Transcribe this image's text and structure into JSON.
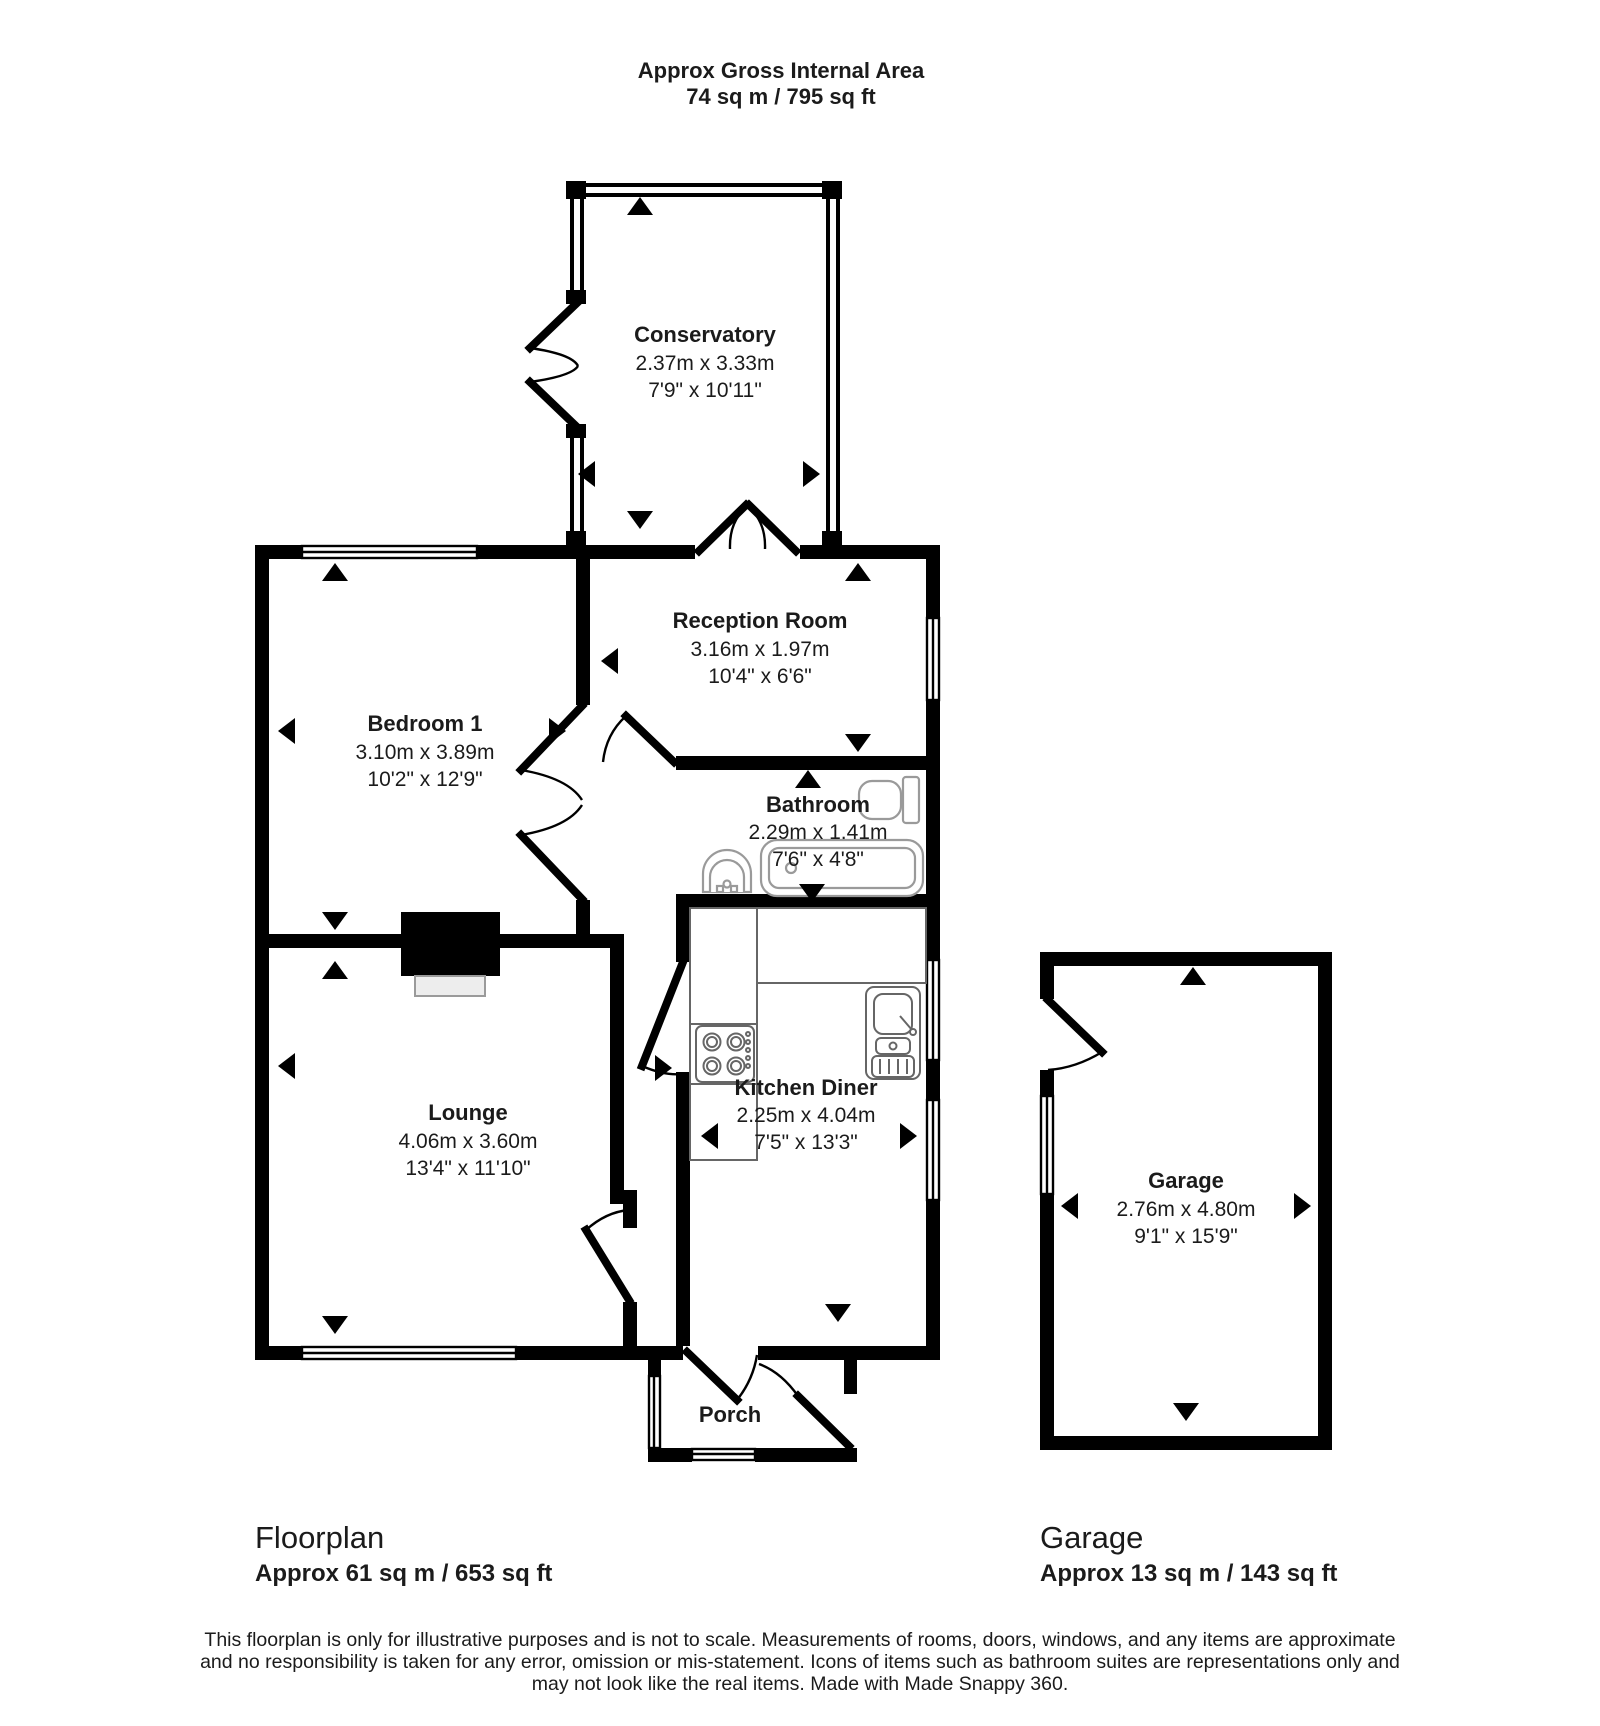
{
  "header": {
    "line1": "Approx Gross Internal Area",
    "line2": "74 sq m / 795 sq ft"
  },
  "rooms": [
    {
      "name": "Conservatory",
      "metric": "2.37m x 3.33m",
      "imperial": "7'9\" x 10'11\""
    },
    {
      "name": "Reception Room",
      "metric": "3.16m x 1.97m",
      "imperial": "10'4\" x 6'6\""
    },
    {
      "name": "Bedroom 1",
      "metric": "3.10m x 3.89m",
      "imperial": "10'2\" x 12'9\""
    },
    {
      "name": "Bathroom",
      "metric": "2.29m x 1.41m",
      "imperial": "7'6\" x 4'8\""
    },
    {
      "name": "Lounge",
      "metric": "4.06m x 3.60m",
      "imperial": "13'4\" x 11'10\""
    },
    {
      "name": "Kitchen Diner",
      "metric": "2.25m x 4.04m",
      "imperial": "7'5\" x 13'3\""
    },
    {
      "name": "Porch"
    },
    {
      "name": "Garage",
      "metric": "2.76m x 4.80m",
      "imperial": "9'1\" x 15'9\""
    }
  ],
  "footer": {
    "floorplan_label": "Floorplan",
    "floorplan_area": "Approx 61 sq m / 653 sq ft",
    "garage_label": "Garage",
    "garage_area": "Approx 13 sq m / 143 sq ft"
  },
  "disclaimer": {
    "line1": "This floorplan is only for illustrative purposes and is not to scale. Measurements of rooms, doors, windows, and any items are approximate",
    "line2": "and no responsibility is taken for any error, omission or mis-statement. Icons of items such as bathroom suites are representations only and",
    "line3": "may not look like the real items. Made with Made Snappy 360."
  },
  "icons": {
    "camera_direction_arrow": "solid black triangle"
  },
  "colors": {
    "wall": "#000000",
    "background": "#ffffff",
    "fixture_outline": "#9a9a9a",
    "hearth_fill": "#ededed"
  }
}
